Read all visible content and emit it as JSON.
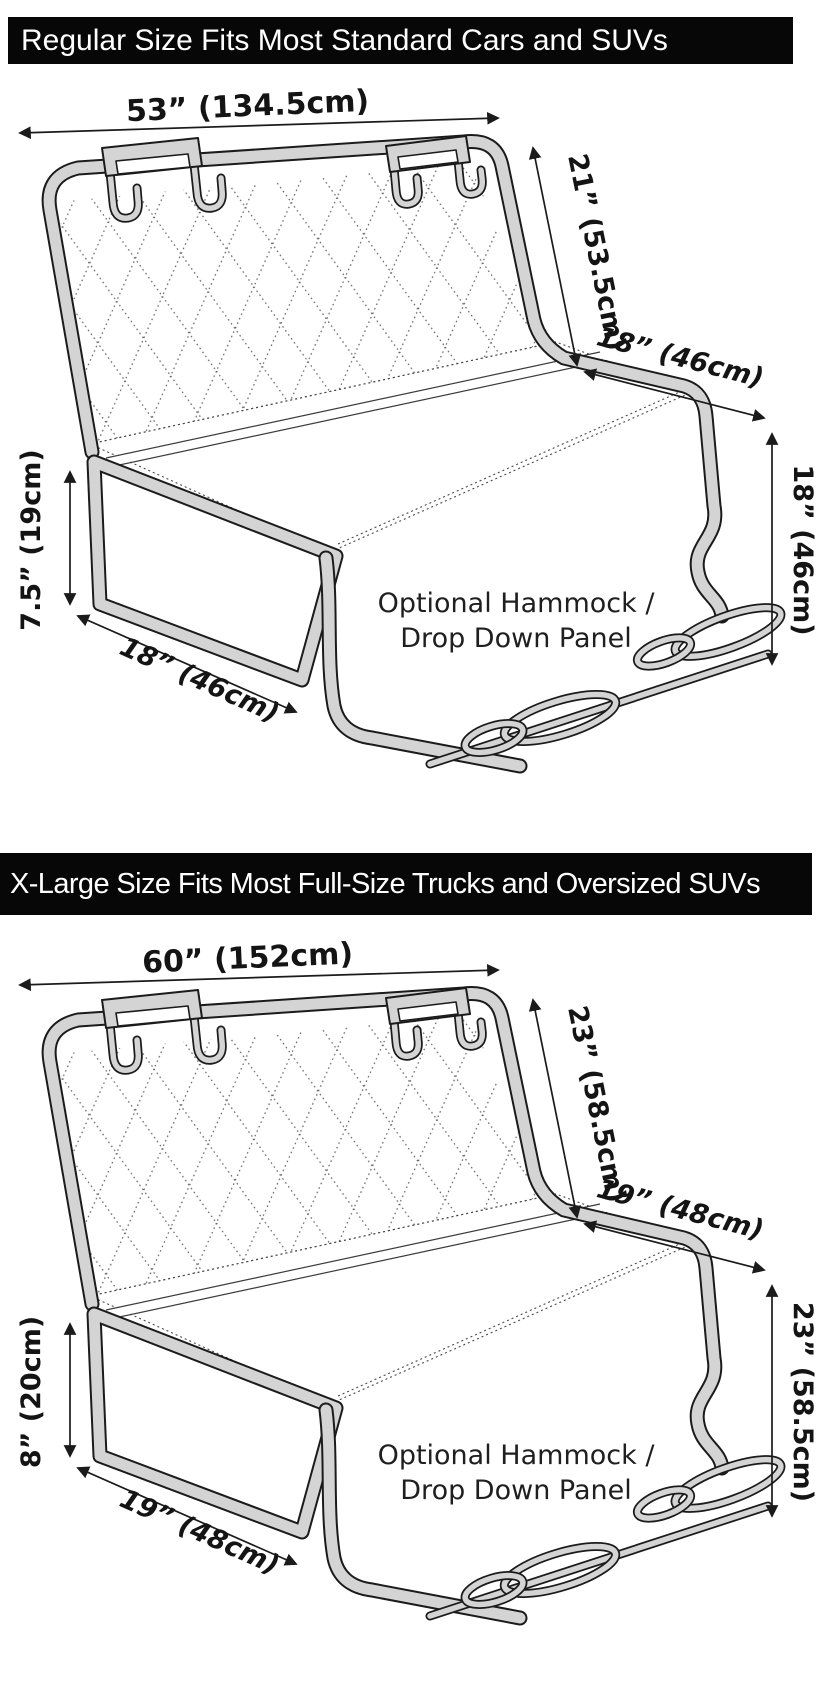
{
  "page": {
    "background": "#ffffff",
    "banner_bg": "#070707",
    "banner_text_color": "#ffffff",
    "tube_gray": "#d4d4d4",
    "line_black": "#1b1b1b"
  },
  "panels": [
    {
      "banner": "Regular Size Fits Most Standard Cars and SUVs",
      "width_label": "53” (134.5cm)",
      "back_height_label": "21” (53.5cm)",
      "seat_depth_label": "18” (46cm)",
      "drop_height_label": "18” (46cm)",
      "flap_height_label": "7.5” (19cm)",
      "flap_width_label": "18” (46cm)",
      "hammock_line1": "Optional Hammock /",
      "hammock_line2": "Drop Down Panel"
    },
    {
      "banner": "X-Large Size Fits Most Full-Size Trucks and Oversized SUVs",
      "width_label": "60” (152cm)",
      "back_height_label": "23” (58.5cm)",
      "seat_depth_label": "19” (48cm)",
      "drop_height_label": "23” (58.5cm)",
      "flap_height_label": "8” (20cm)",
      "flap_width_label": "19” (48cm)",
      "hammock_line1": "Optional Hammock /",
      "hammock_line2": "Drop Down Panel"
    }
  ]
}
